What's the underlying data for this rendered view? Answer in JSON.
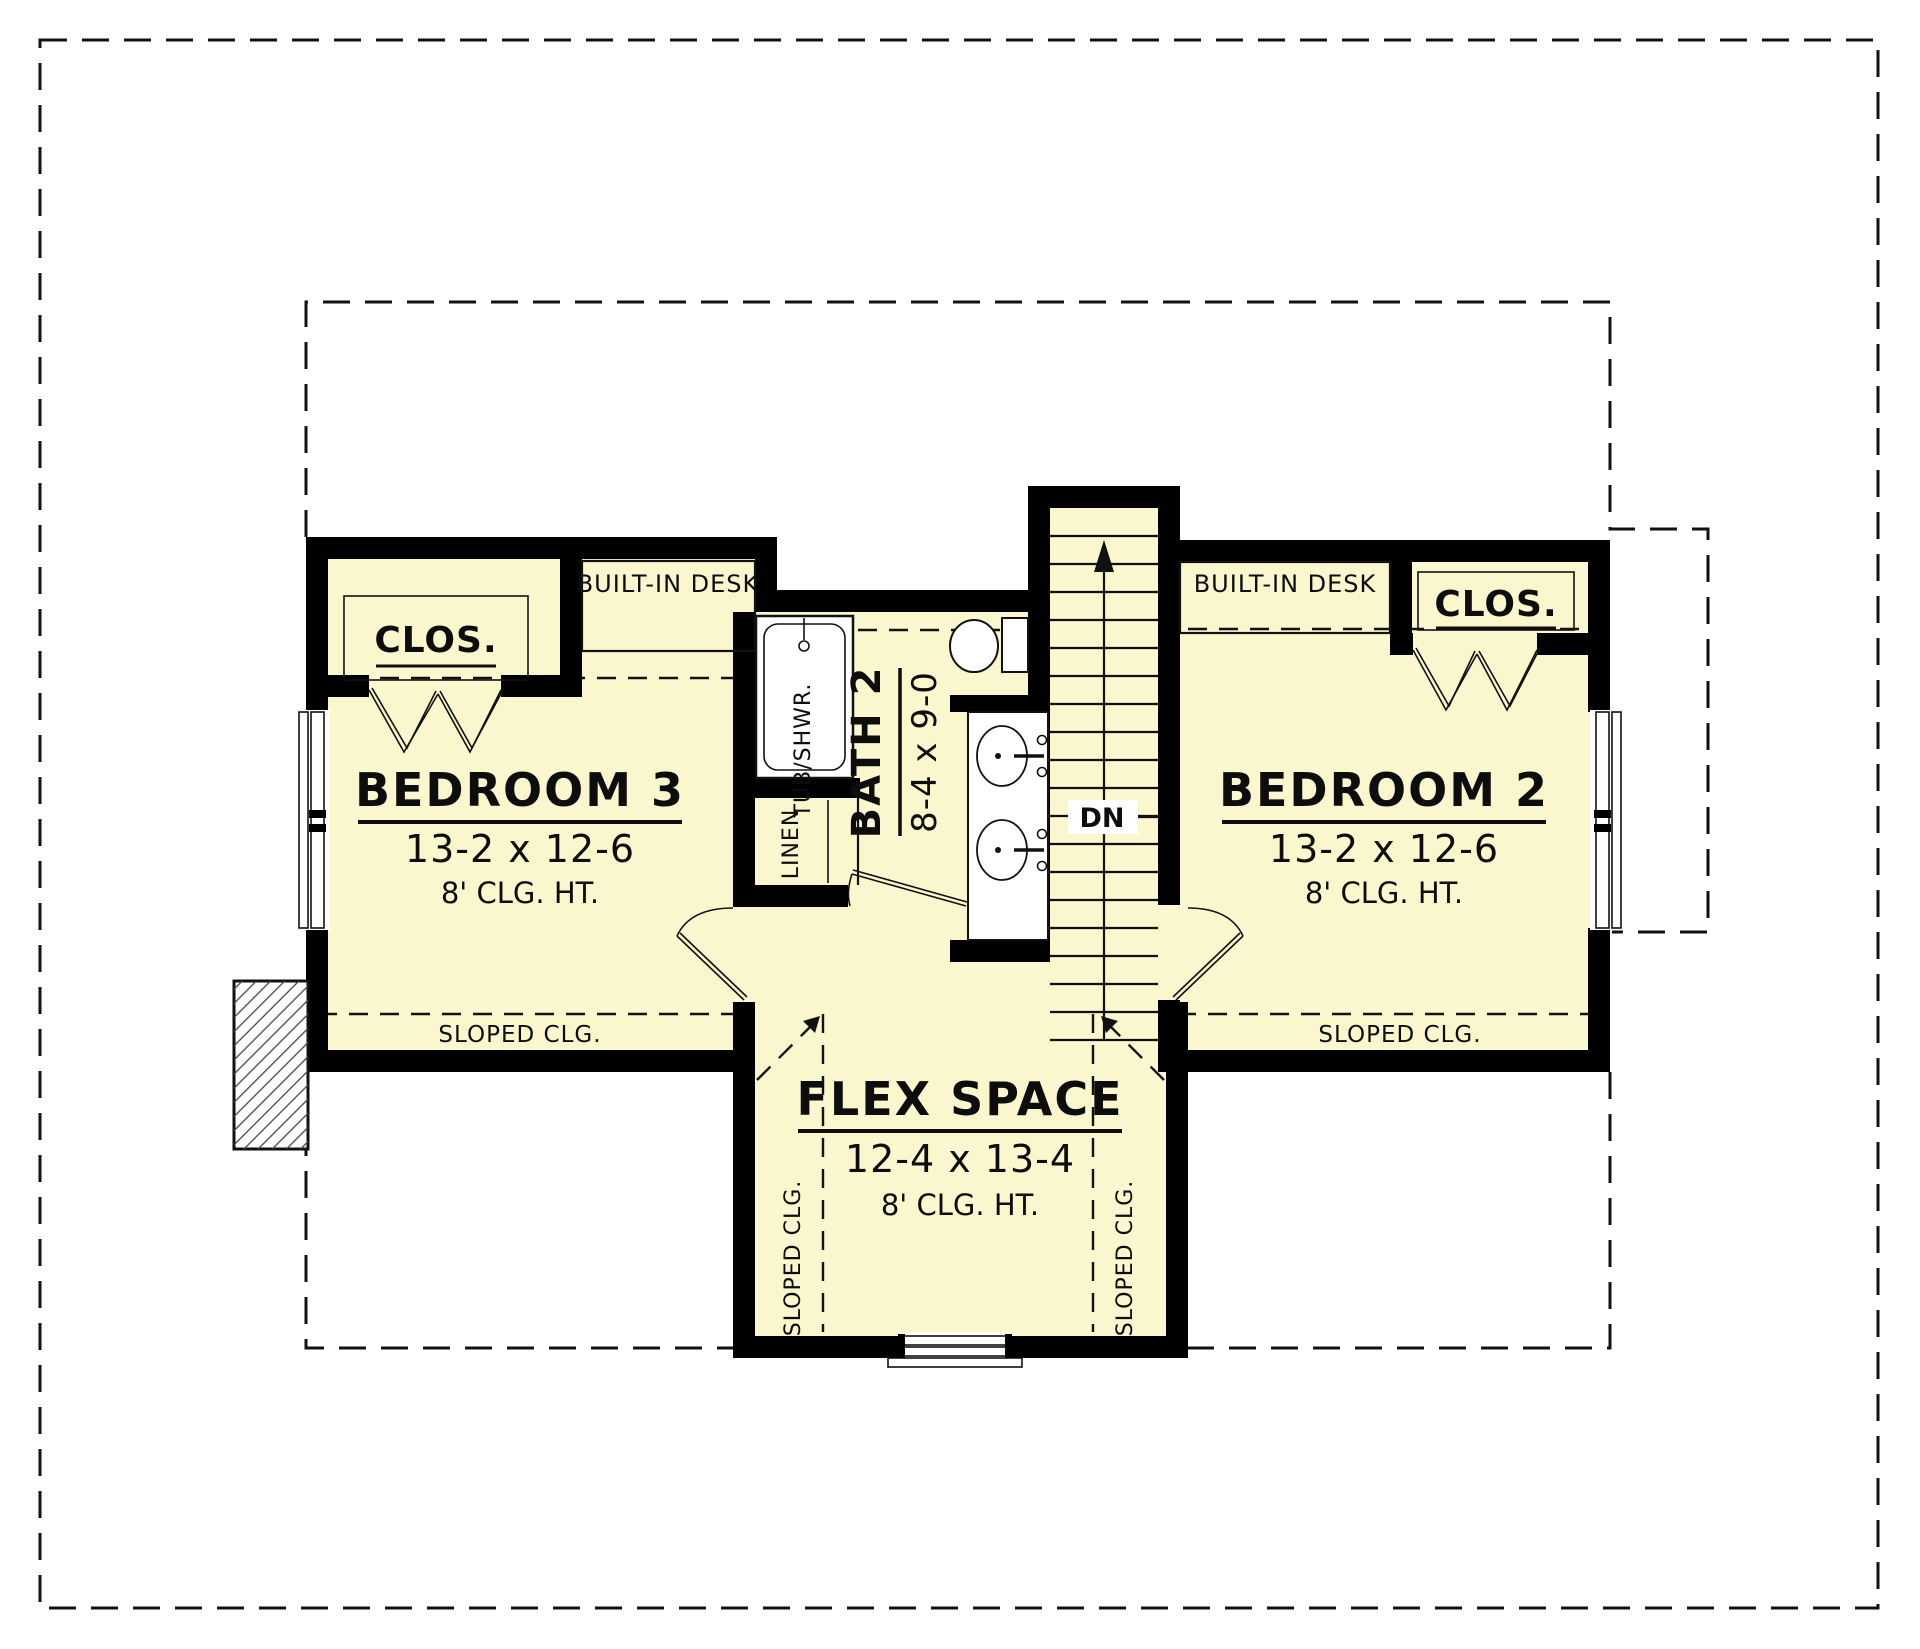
{
  "plan": {
    "bedroom3": {
      "title": "BEDROOM 3",
      "dims": "13-2 x 12-6",
      "ceiling": "8' CLG. HT."
    },
    "bedroom2": {
      "title": "BEDROOM 2",
      "dims": "13-2 x 12-6",
      "ceiling": "8' CLG. HT."
    },
    "flex": {
      "title": "FLEX SPACE",
      "dims": "12-4 x 13-4",
      "ceiling": "8' CLG. HT."
    },
    "bath2": {
      "title": "BATH 2",
      "dims": "8-4 x 9-0"
    },
    "closet_left": "CLOS.",
    "closet_right": "CLOS.",
    "desk_left": "BUILT-IN DESK",
    "desk_right": "BUILT-IN DESK",
    "tub": "TUB/SHWR.",
    "linen": "LINEN",
    "stairs_down": "DN",
    "sloped_bed3": "SLOPED CLG.",
    "sloped_bed2": "SLOPED CLG.",
    "sloped_flex_left": "SLOPED CLG.",
    "sloped_flex_right": "SLOPED CLG.",
    "colors": {
      "room_fill": "#FAF7CE",
      "wall": "#000000",
      "line": "#111111",
      "paper": "#FFFFFF"
    }
  }
}
